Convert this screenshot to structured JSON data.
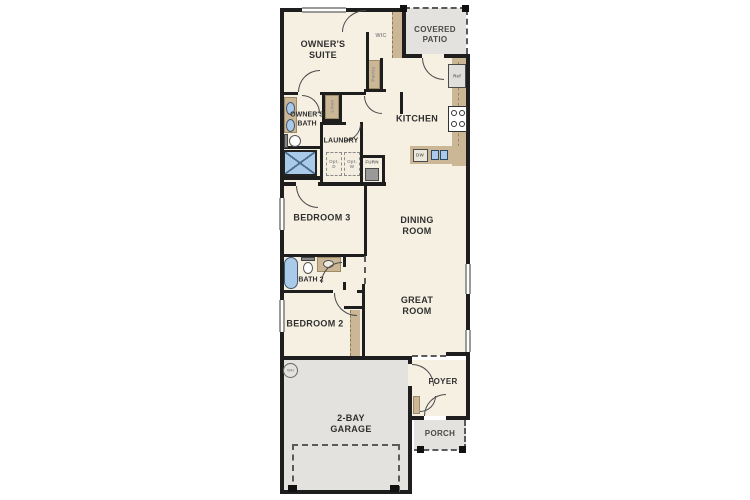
{
  "colors": {
    "wall": "#1e1e1e",
    "floor_cream": "#f6f0e3",
    "floor_gray": "#e3e2de",
    "cabinet_tan": "#cbb795",
    "fixture_blue": "#a9cae8"
  },
  "labels": {
    "owners_suite": "OWNER'S\nSUITE",
    "wic": "WIC",
    "covered_patio": "COVERED\nPATIO",
    "pantry": "Pantry",
    "ref": "Ref",
    "kitchen": "KITCHEN",
    "owners_bath": "OWNER'S\nBATH",
    "linen": "Linen",
    "laundry": "LAUNDRY",
    "opt_d": "Opt.\nD",
    "opt_w": "Opt.\nW",
    "furn": "FURN",
    "dw": "DW",
    "bedroom3": "BEDROOM 3",
    "dining_room": "DINING\nROOM",
    "bath2": "BATH 2",
    "bedroom2": "BEDROOM 2",
    "great_room": "GREAT\nROOM",
    "garage": "2-BAY\nGARAGE",
    "foyer": "FOYER",
    "porch": "PORCH",
    "wh": "WH"
  }
}
